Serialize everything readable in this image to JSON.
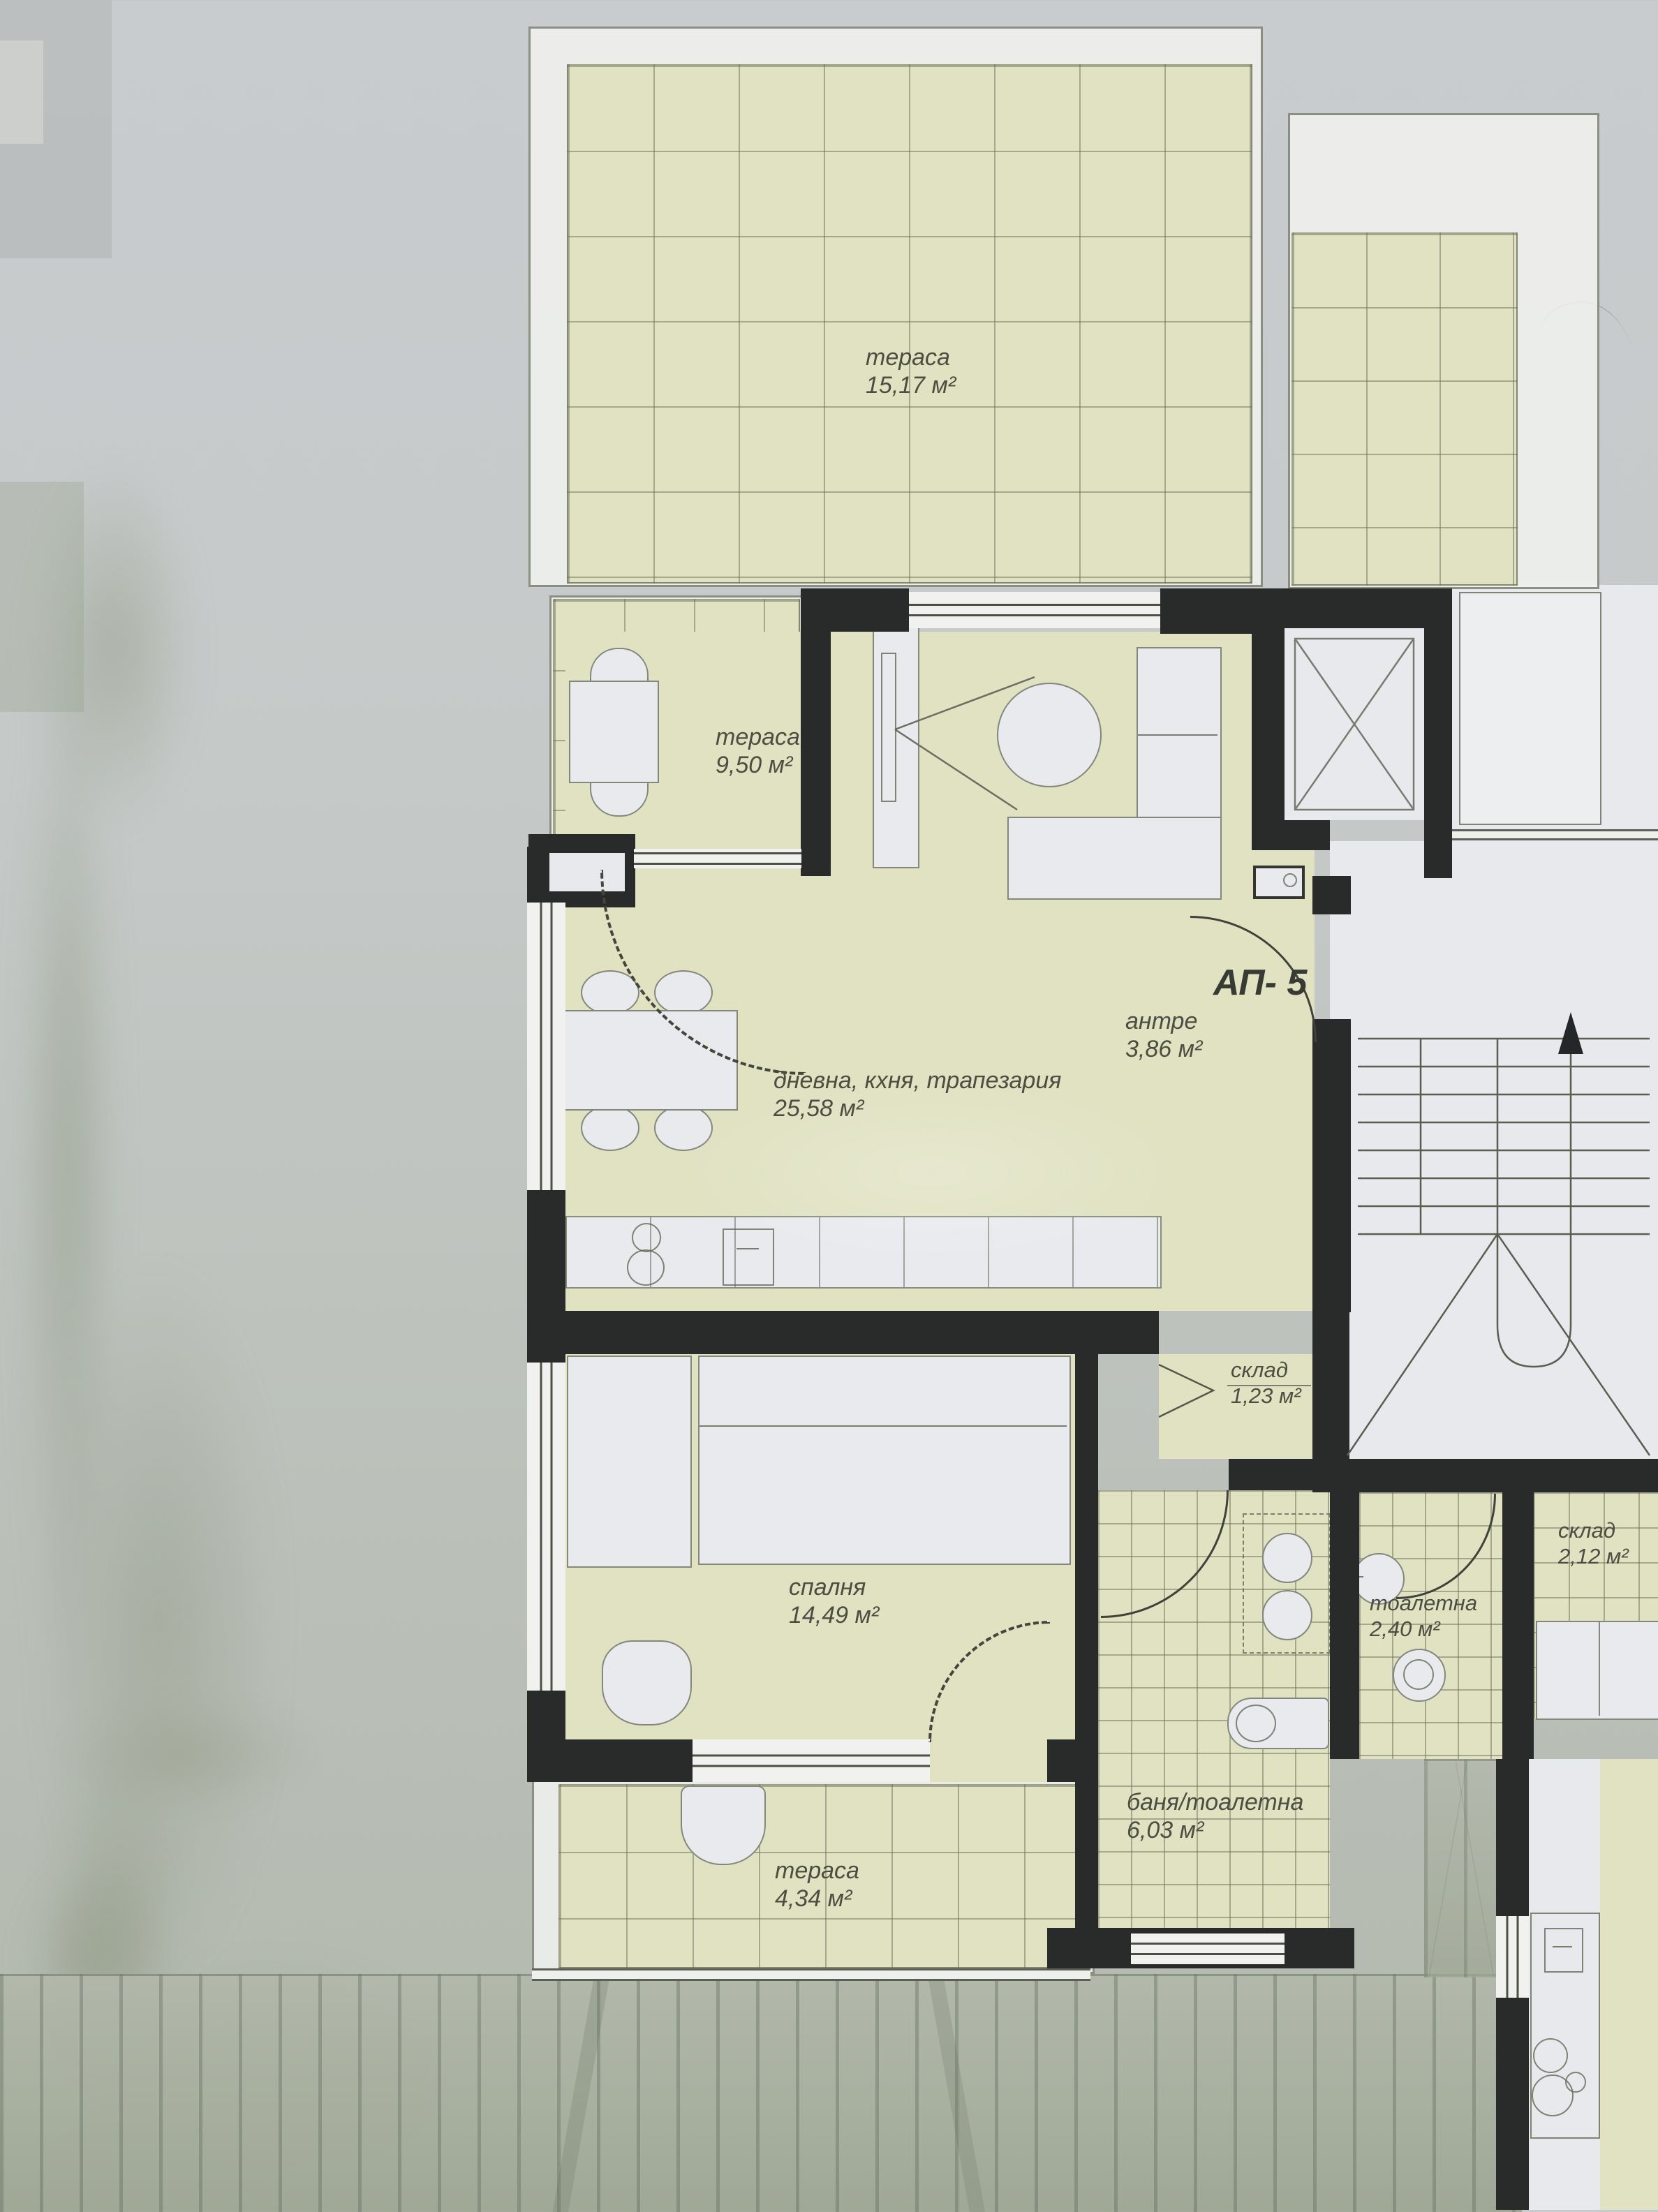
{
  "plan": {
    "apartment_label": "АП- 5",
    "rooms": {
      "terrace_top": {
        "name": "тераса",
        "area": "15,17 м²"
      },
      "terrace_left": {
        "name": "тераса",
        "area": "9,50 м²"
      },
      "living": {
        "name": "дневна, кхня, трапезария",
        "area": "25,58 м²"
      },
      "antre": {
        "name": "антре",
        "area": "3,86 м²"
      },
      "storage_small": {
        "name": "склад",
        "area": "1,23 м²"
      },
      "bedroom": {
        "name": "спалня",
        "area": "14,49 м²"
      },
      "bathroom": {
        "name": "баня/тоалетна",
        "area": "6,03 м²"
      },
      "toilet": {
        "name": "тоалетна",
        "area": "2,40 м²"
      },
      "storage_right": {
        "name": "склад",
        "area": "2,12 м²"
      },
      "terrace_bottom": {
        "name": "тераса",
        "area": "4,34 м²"
      }
    },
    "colors": {
      "tile": "#e0e2c2",
      "wall": "#282b2a",
      "furniture": "#e9eaee",
      "line": "#4c4f45",
      "label": "#4b4e40"
    }
  }
}
